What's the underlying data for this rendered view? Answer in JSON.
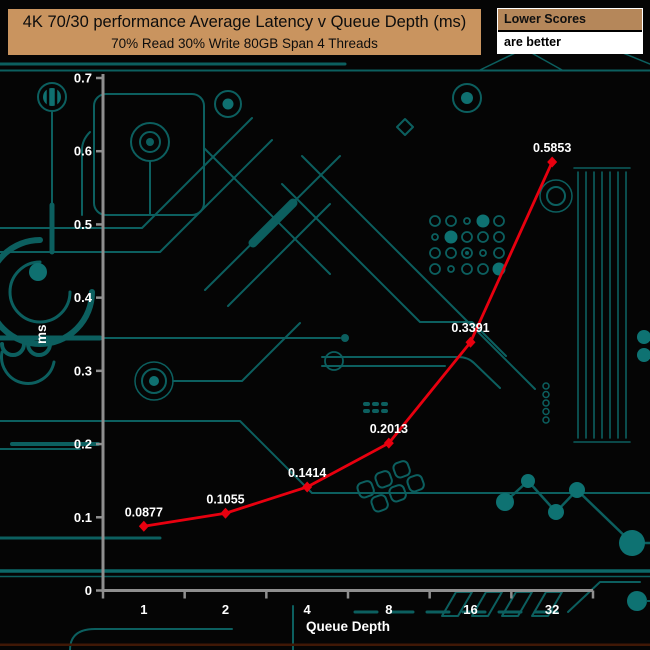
{
  "header": {
    "title": "4K 70/30 performance Average Latency v Queue Depth (ms)",
    "subtitle": "70% Read 30% Write 80GB Span 4 Threads"
  },
  "legend": {
    "line1": "Lower Scores",
    "line2": "are better"
  },
  "colors": {
    "title_bg": "#c9945f",
    "legend_bg": "#b5875a",
    "series": "#e8000f",
    "axis": "#8f8f8f",
    "text": "#ffffff",
    "circuit": "#0c5f5f"
  },
  "chart_data": {
    "type": "line",
    "categories": [
      "1",
      "2",
      "4",
      "8",
      "16",
      "32"
    ],
    "values": [
      0.0877,
      0.1055,
      0.1414,
      0.2013,
      0.3391,
      0.5853
    ],
    "point_labels": [
      "0.0877",
      "0.1055",
      "0.1414",
      "0.2013",
      "0.3391",
      "0.5853"
    ],
    "title": "4K 70/30 performance Average Latency v Queue Depth (ms)",
    "subtitle": "70% Read 30% Write 80GB Span 4 Threads",
    "xlabel": "Queue Depth",
    "ylabel": "ms",
    "ylim": [
      0,
      0.7
    ],
    "ytick_labels": [
      "0",
      "0.1",
      "0.2",
      "0.3",
      "0.4",
      "0.5",
      "0.6",
      "0.7"
    ],
    "x_scale": "log2-categorical",
    "grid": false,
    "legend_note": "Lower Scores are better",
    "series_color": "#e8000f",
    "marker": "diamond"
  }
}
